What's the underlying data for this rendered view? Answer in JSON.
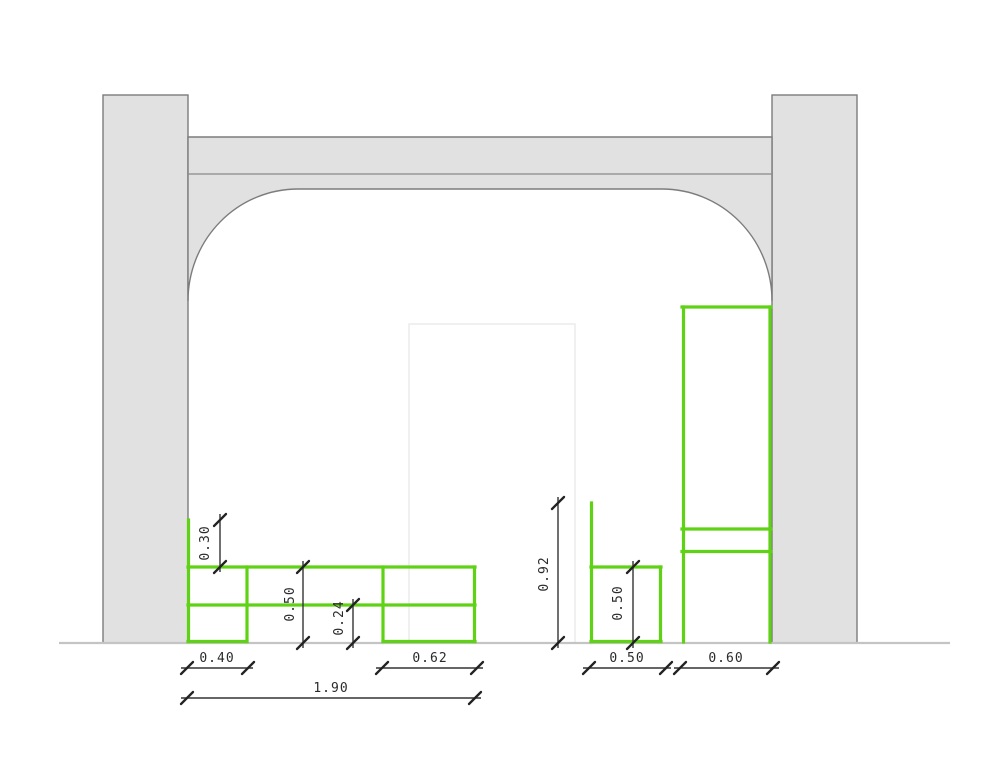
{
  "drawing": {
    "kind": "architectural-elevation-with-furniture",
    "colors": {
      "furniture_green": "#5fd216",
      "masonry_fill": "#e1e1e1",
      "masonry_edge": "#7c7c7c",
      "dimension_ink": "#333333",
      "ground_line": "#c4c4c4",
      "niche_outline": "#ececec"
    },
    "dimensions": {
      "backsplash_height": "0.30",
      "counter_height": "0.50",
      "plinth_height": "0.24",
      "left_module_width": "0.40",
      "right_module_width": "0.62",
      "counter_total_width": "1.90",
      "side_panel_height": "0.92",
      "small_unit_height": "0.50",
      "small_unit_width": "0.50",
      "tall_unit_width": "0.60"
    }
  }
}
